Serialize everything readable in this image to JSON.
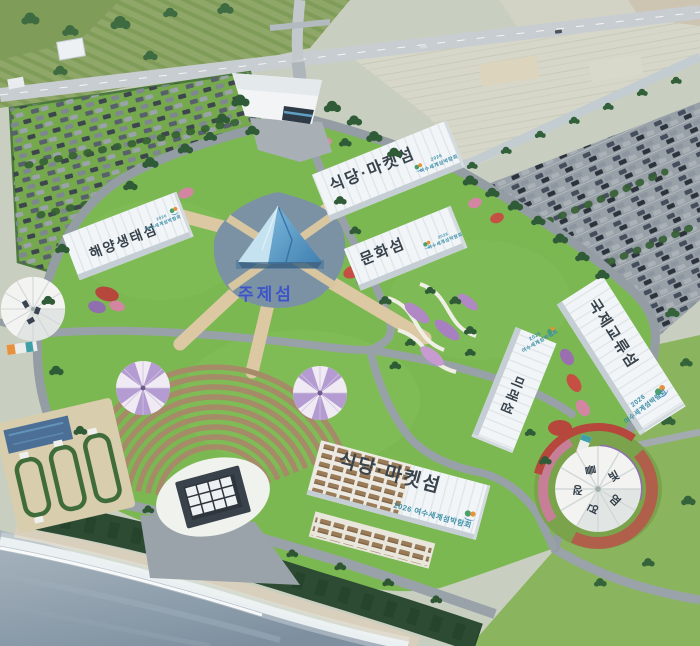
{
  "islands": {
    "restaurant_market_north": "식당·마켓섬",
    "culture": "문화섬",
    "marine_ecology": "해양생태섬",
    "theme": "주제섬",
    "international_exchange": "국제교류섬",
    "future": "미래섬",
    "restaurant_market_south": "식당·마켓섬"
  },
  "expo_logo": {
    "year": "2026",
    "name": "여수세계섬박람회",
    "full": "2026 여수세계섬박람회"
  },
  "dome_pavilion": {
    "chars": [
      "를",
      "빛",
      "염",
      "연",
      "정"
    ]
  },
  "palette": {
    "lawn": "#7cb852",
    "upland": "#c9cfc0",
    "ocean": "#8797a6",
    "lake": "#7b92a4",
    "road": "#99a2a9",
    "promenade": "#dcc9a4",
    "building": "#f2f5f7",
    "label_dark": "#38434c",
    "theme_label_blue": "#3d55c8",
    "logo_teal": "#3d8fa8",
    "seat_brown": "#a58b68",
    "coastal_forest": "#2d4a33",
    "flower_red": "#b5473c",
    "flower_pink": "#d286a2",
    "flower_purple": "#8f6fae"
  }
}
